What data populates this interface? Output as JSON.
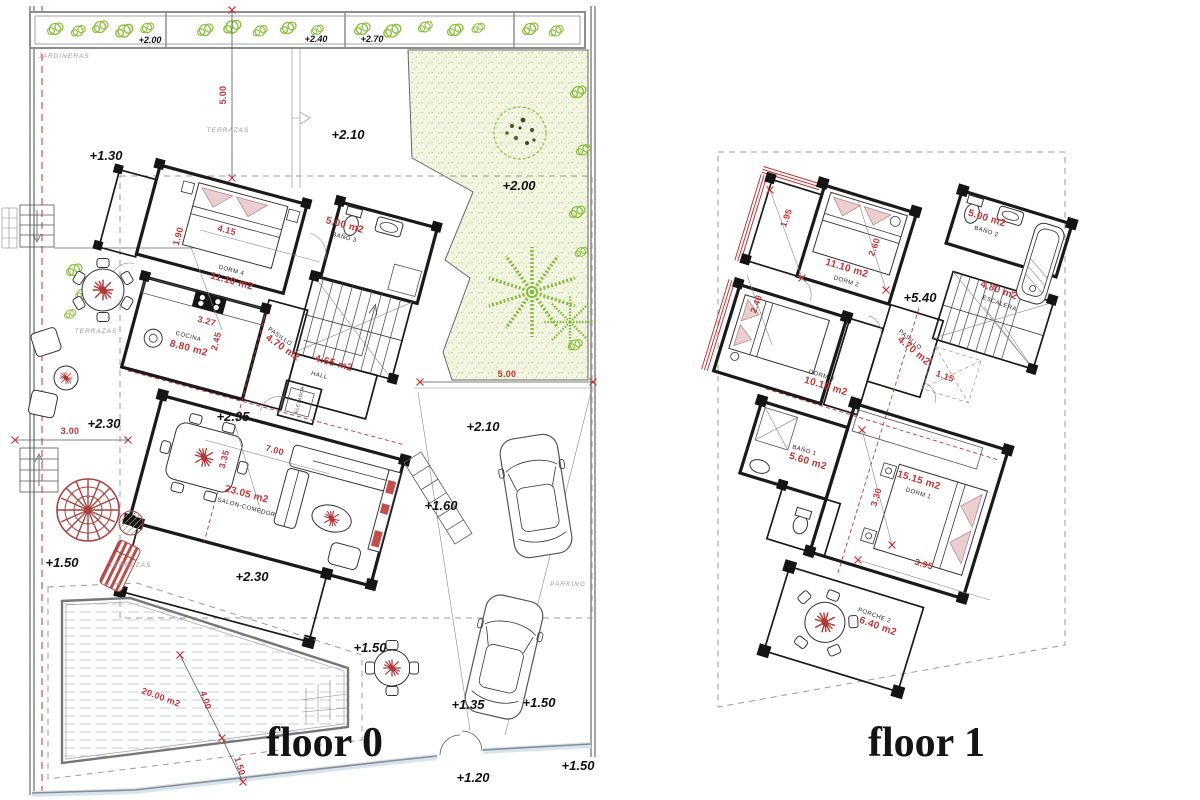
{
  "colors": {
    "wall_black": "#1a1a1a",
    "dimension_red": "#c03434",
    "vegetation_green": "#8cbf3f",
    "garden_fill": "#f2f5e2",
    "pool_blue": "#b9cfe6",
    "furniture_pink": "#e9cfcf",
    "boundary_gray": "#9a9a9a"
  },
  "floor0": {
    "title": "floor 0",
    "labels": {
      "jardineras": "JARDINERAS",
      "terrazas_upper": "TERRAZAS",
      "terrazas_left": "TERRAZAS",
      "terrazas_lower": "TERRAZAS",
      "parking": "PARKING"
    },
    "planter_levels": [
      "+2.00",
      "+2.40",
      "+2.70"
    ],
    "levels": {
      "terrace_upper": "+1.30",
      "path_right": "+2.10",
      "garden": "+2.00",
      "salon": "+2.35",
      "terrace_tiles": "+2.30",
      "terrace_left": "+2.30",
      "terrace_lower": "+1.50",
      "table_court": "+1.50",
      "ramp": "+1.60",
      "parking_upper": "+2.10",
      "entry_left": "+1.35",
      "parking_spot": "+1.50",
      "street_entry": "+1.20",
      "street_right": "+1.50"
    },
    "dims": {
      "plot_top": "5.00",
      "garden_width": "5.00",
      "terrace_width": "3.00",
      "dorm4_width": "4.15",
      "dorm4_depth": "1.90",
      "cocina_width": "3.27",
      "cocina_depth": "2.45",
      "salon_width": "7.00",
      "salon_depth": "3.35",
      "pool_area": "20.00 m2",
      "pool_width": "4.00",
      "pool_step": "1.50"
    },
    "rooms": {
      "dorm4": {
        "name": "DORM 4",
        "area": "11.10 m2"
      },
      "bano3": {
        "name": "BAÑO 3",
        "area": "5.00 m2"
      },
      "cocina": {
        "name": "COCINA",
        "area": "8.80 m2"
      },
      "pasillo": {
        "name": "PASILLO",
        "area": "4.70 m2"
      },
      "hall": {
        "name": "HALL",
        "area": "4.65 m2"
      },
      "elevador": {
        "name": "ELEVADOR"
      },
      "salon": {
        "name": "SALON-COMEDOR",
        "area": "23.05 m2"
      }
    }
  },
  "floor1": {
    "title": "floor 1",
    "level_main": "+5.40",
    "dims": {
      "dorm2_entry": "1.95",
      "dorm2_width": "2.60",
      "dorm3_depth": "2.40",
      "hall_step": "1.15",
      "dorm1_depth": "3.30",
      "dorm1_width": "3.95"
    },
    "rooms": {
      "dorm2": {
        "name": "DORM 2",
        "area": "11.10 m2"
      },
      "bano2": {
        "name": "BAÑO 2",
        "area": "5.00 m2"
      },
      "escalera": {
        "name": "ESCALERA",
        "area": "4.80 m2"
      },
      "pasillo": {
        "name": "PASILLO",
        "area": "4.70 m2"
      },
      "dorm3": {
        "name": "DORM 3",
        "area": "10.10 m2"
      },
      "bano1": {
        "name": "BAÑO 1",
        "area": "5.60 m2"
      },
      "dorm1": {
        "name": "DORM 1",
        "area": "15.15 m2"
      },
      "porche2": {
        "name": "PORCHE 2",
        "area": "6.40 m2"
      }
    }
  }
}
